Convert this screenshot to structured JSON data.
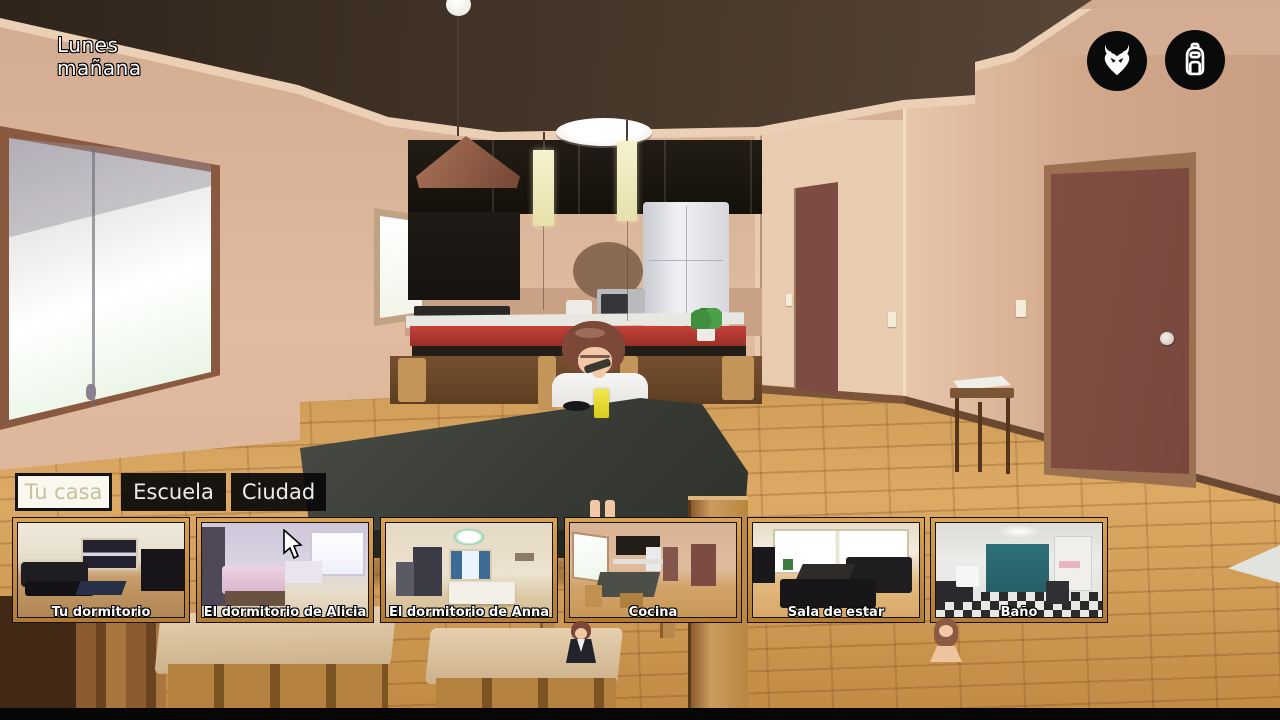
{
  "hud": {
    "day": "Lunes",
    "time": "mañana",
    "icons": [
      {
        "name": "demon-icon"
      },
      {
        "name": "backpack-icon"
      }
    ]
  },
  "nav": {
    "tabs": [
      {
        "label": "Tu casa",
        "active": true
      },
      {
        "label": "Escuela",
        "active": false
      },
      {
        "label": "Ciudad",
        "active": false
      }
    ]
  },
  "rooms": {
    "items": [
      {
        "label": "Tu dormitorio"
      },
      {
        "label": "El dormitorio de Alicia"
      },
      {
        "label": "El dormitorio de Anna"
      },
      {
        "label": "Cocina"
      },
      {
        "label": "Sala de estar"
      },
      {
        "label": "Baño"
      }
    ]
  },
  "markers": [
    {
      "name": "girl-uniform-marker",
      "near_room": "Cocina"
    },
    {
      "name": "girl-bathing-marker",
      "near_room": "Baño"
    }
  ],
  "colors": {
    "thumb_border_gold": "#c08a3e",
    "tab_active_bg": "#faf7ee",
    "tab_active_text": "#c6c19a",
    "tab_inactive_bg": "#0d0d0d",
    "hud_text": "#ffffff",
    "icon_bg": "#0a0a0a"
  }
}
